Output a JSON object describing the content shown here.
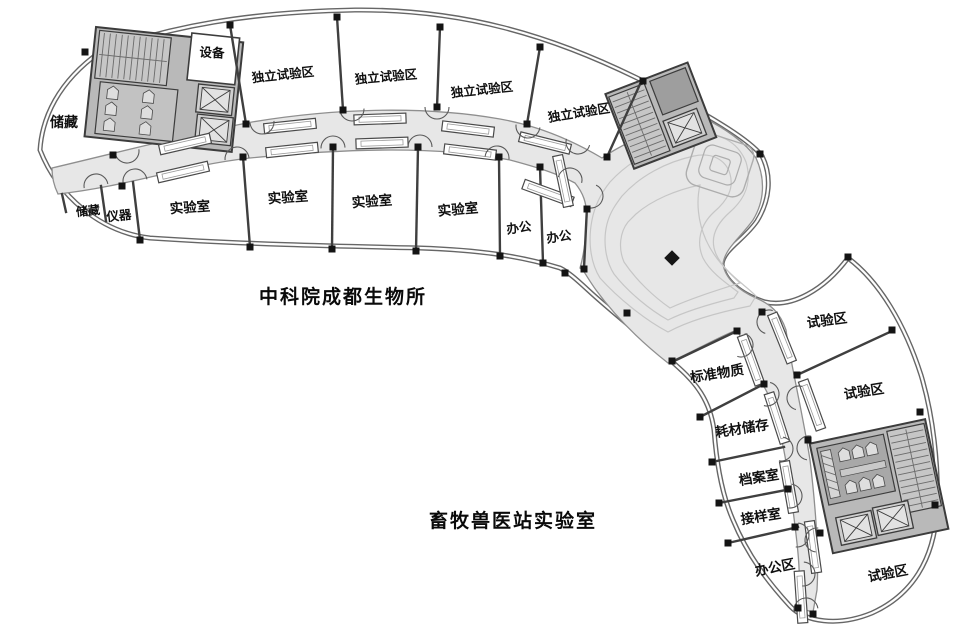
{
  "plan": {
    "captions": {
      "institute": "中科院成都生物所",
      "veterinary": "畜牧兽医站实验室"
    },
    "rooms": {
      "storage_upper": "储藏",
      "equipment": "设备",
      "indep_1": "独立试验区",
      "indep_2": "独立试验区",
      "indep_3": "独立试验区",
      "indep_4": "独立试验区",
      "storage_lower": "储藏",
      "instruments": "仪器",
      "lab_1": "实验室",
      "lab_2": "实验室",
      "lab_3": "实验室",
      "lab_4": "实验室",
      "office_1": "办公",
      "office_2": "办公",
      "std_materials": "标准物质",
      "consumables": "耗材储存",
      "archive": "档案室",
      "sample_room": "接样室",
      "office_area": "办公区",
      "test_1": "试验区",
      "test_2": "试验区",
      "test_3": "试验区"
    },
    "colors": {
      "wall": "#3f3f3f",
      "circulation": "#e7e7e7",
      "service_core": "#b9b9b9",
      "core_room": "#a8a8a8",
      "column": "#141414",
      "background": "#ffffff"
    }
  }
}
